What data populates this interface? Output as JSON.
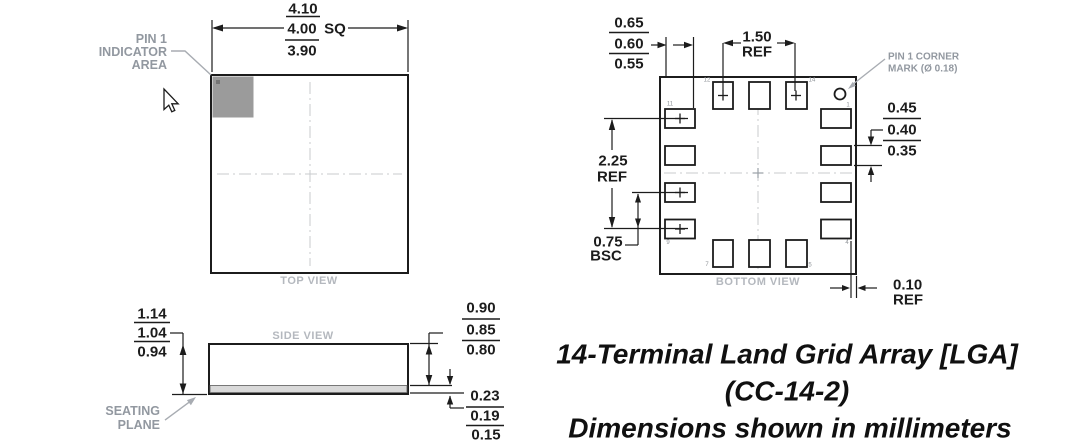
{
  "colors": {
    "line_black": "#1c1c1c",
    "annotation_gray": "#9298a0",
    "view_label_gray": "#b4b8be",
    "pin1_indicator_gray": "#9b9b9b",
    "land_band_gray": "#d9d9d9",
    "centerline_gray": "#c8cbce",
    "background": "#ffffff"
  },
  "top_view": {
    "view_label": "TOP VIEW",
    "pin1_label": {
      "line1": "PIN 1",
      "line2": "INDICATOR",
      "line3": "AREA"
    },
    "size_dim": {
      "max": "4.10",
      "nom": "4.00",
      "square_suffix": "SQ",
      "min": "3.90"
    }
  },
  "side_view": {
    "view_label": "SIDE VIEW",
    "height_dim": {
      "max": "1.14",
      "nom": "1.04",
      "min": "0.94"
    },
    "body_dim": {
      "max": "0.90",
      "nom": "0.85",
      "min": "0.80"
    },
    "land_dim": {
      "max": "0.23",
      "nom": "0.19",
      "min": "0.15"
    },
    "seating_plane_label": {
      "line1": "SEATING",
      "line2": "PLANE"
    }
  },
  "bottom_view": {
    "view_label": "BOTTOM VIEW",
    "pad_length_dim": {
      "max": "0.65",
      "nom": "0.60",
      "min": "0.55"
    },
    "span2_dim": {
      "value": "1.50",
      "qualifier": "REF"
    },
    "span3_dim": {
      "value": "2.25",
      "qualifier": "REF"
    },
    "pitch_dim": {
      "value": "0.75",
      "qualifier": "BSC"
    },
    "pad_width_dim": {
      "max": "0.45",
      "nom": "0.40",
      "min": "0.35"
    },
    "edge_gap_dim": {
      "value": "0.10",
      "qualifier": "REF"
    },
    "pin1_mark_label": {
      "line1": "PIN 1 CORNER",
      "line2": "MARK (Ø 0.18)"
    },
    "pin_numbers": {
      "p1": "1",
      "p4": "4",
      "p5": "5",
      "p7": "7",
      "p9": "9",
      "p11": "11",
      "p12": "12",
      "p14": "14"
    }
  },
  "title_block": {
    "line1": "14-Terminal Land Grid Array [LGA]",
    "line2": "(CC-14-2)",
    "line3": "Dimensions shown in millimeters"
  }
}
